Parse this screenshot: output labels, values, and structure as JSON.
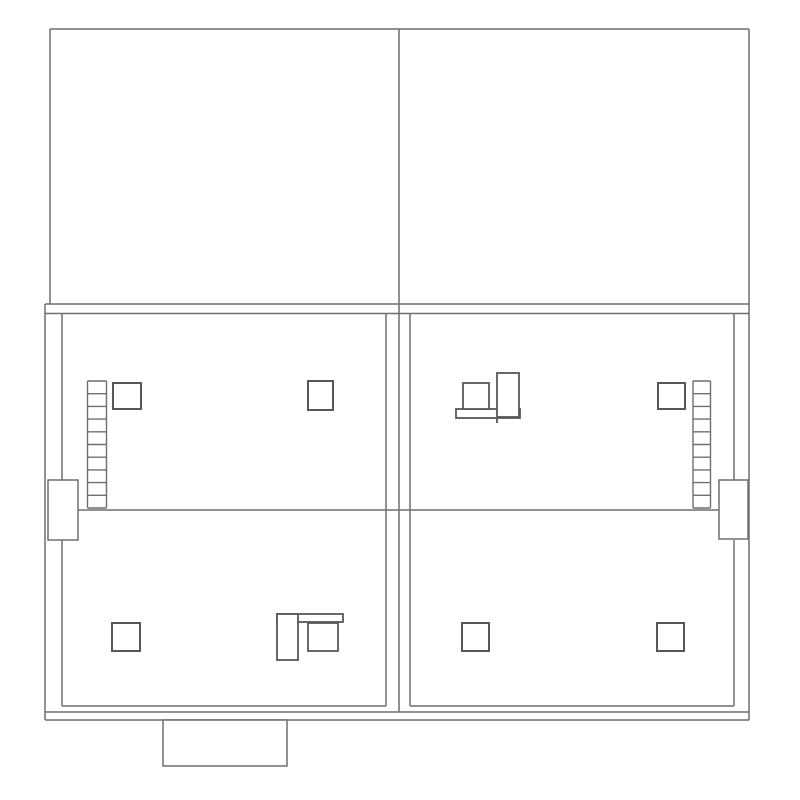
{
  "canvas": {
    "width": 800,
    "height": 800,
    "background": "#ffffff"
  },
  "style": {
    "wall_color": "#6f6f6f",
    "wall_width": 1.5,
    "detail_color": "#585858",
    "detail_width": 2,
    "ladder_color": "#6f6f6f",
    "ladder_width": 1.4,
    "fill_color": "#ffffff"
  },
  "walls": [
    {
      "name": "top-outline-top-edge",
      "x1": 50,
      "y1": 29,
      "x2": 749,
      "y2": 29
    },
    {
      "name": "top-left-outer-wall",
      "x1": 50,
      "y1": 29,
      "x2": 50,
      "y2": 304
    },
    {
      "name": "right-outer-wall",
      "x1": 749,
      "y1": 29,
      "x2": 749,
      "y2": 720
    },
    {
      "name": "center-dividing-wall",
      "x1": 399,
      "y1": 29,
      "x2": 399,
      "y2": 712
    },
    {
      "name": "slab-band-upper-line",
      "x1": 45,
      "y1": 304,
      "x2": 749,
      "y2": 304
    },
    {
      "name": "slab-band-lower-line",
      "x1": 45,
      "y1": 313.5,
      "x2": 749,
      "y2": 313.5
    },
    {
      "name": "left-outer-wall",
      "x1": 45,
      "y1": 304,
      "x2": 45,
      "y2": 720
    },
    {
      "name": "left-inner-wall-upper",
      "x1": 62,
      "y1": 313.5,
      "x2": 62,
      "y2": 480
    },
    {
      "name": "left-inner-wall-lower",
      "x1": 62,
      "y1": 540,
      "x2": 62,
      "y2": 706
    },
    {
      "name": "right-inner-wall-upper",
      "x1": 734,
      "y1": 313.5,
      "x2": 734,
      "y2": 480
    },
    {
      "name": "right-inner-wall-lower",
      "x1": 734,
      "y1": 540,
      "x2": 734,
      "y2": 706
    },
    {
      "name": "center-wall-left-line",
      "x1": 386,
      "y1": 313.5,
      "x2": 386,
      "y2": 706
    },
    {
      "name": "center-wall-right-line",
      "x1": 410,
      "y1": 313.5,
      "x2": 410,
      "y2": 706
    },
    {
      "name": "middle-room-divider",
      "x1": 78,
      "y1": 510,
      "x2": 720,
      "y2": 510
    },
    {
      "name": "inner-floor-line-left",
      "x1": 62,
      "y1": 706,
      "x2": 386,
      "y2": 706
    },
    {
      "name": "inner-floor-line-right",
      "x1": 410,
      "y1": 706,
      "x2": 734,
      "y2": 706
    },
    {
      "name": "bottom-wall-upper-line",
      "x1": 45,
      "y1": 712,
      "x2": 749,
      "y2": 712
    },
    {
      "name": "bottom-wall-lower-line",
      "x1": 45,
      "y1": 720,
      "x2": 749,
      "y2": 720
    }
  ],
  "boxes": [
    {
      "name": "left-wall-pier-box",
      "x": 48,
      "y": 480,
      "w": 30,
      "h": 60
    },
    {
      "name": "right-wall-pier-box",
      "x": 719,
      "y": 480,
      "w": 29,
      "h": 59
    },
    {
      "name": "bottom-extension-box",
      "x": 163,
      "y": 720,
      "w": 124,
      "h": 46
    }
  ],
  "columns": [
    {
      "name": "column-upper-left-a",
      "x": 113,
      "y": 383,
      "w": 28,
      "h": 26
    },
    {
      "name": "column-upper-left-b",
      "x": 308,
      "y": 381,
      "w": 25,
      "h": 29
    },
    {
      "name": "column-upper-right",
      "x": 658,
      "y": 383,
      "w": 27,
      "h": 26
    },
    {
      "name": "column-lower-left",
      "x": 112,
      "y": 623,
      "w": 28,
      "h": 28
    },
    {
      "name": "column-lower-right-a",
      "x": 462,
      "y": 623,
      "w": 27,
      "h": 28
    },
    {
      "name": "column-lower-right-b",
      "x": 657,
      "y": 623,
      "w": 27,
      "h": 28
    }
  ],
  "fixtures": [
    {
      "name": "fixture-upper-right-room",
      "rects": [
        {
          "name": "fixture-base-bar",
          "x": 456,
          "y": 409,
          "w": 64,
          "h": 9,
          "filled": false
        },
        {
          "name": "fixture-square-unit",
          "x": 463,
          "y": 383,
          "w": 26,
          "h": 26,
          "filled": true
        },
        {
          "name": "fixture-tall-unit",
          "x": 497,
          "y": 373,
          "w": 22,
          "h": 44,
          "filled": true
        }
      ],
      "ticks": [
        {
          "name": "fixture-tick-line",
          "x1": 497,
          "y1": 418,
          "x2": 497,
          "y2": 423
        }
      ]
    },
    {
      "name": "fixture-lower-left-room",
      "rects": [
        {
          "name": "fixture-base-bar",
          "x": 277,
          "y": 614,
          "w": 66,
          "h": 8,
          "filled": false
        },
        {
          "name": "fixture-tall-unit",
          "x": 277,
          "y": 614,
          "w": 21,
          "h": 46,
          "filled": true
        },
        {
          "name": "fixture-square-unit",
          "x": 308,
          "y": 623,
          "w": 30,
          "h": 28,
          "filled": true
        }
      ],
      "ticks": []
    }
  ],
  "ladders": [
    {
      "name": "ladder-left",
      "x1": 87.5,
      "y1": 381,
      "x2": 106.5,
      "y2": 508,
      "rungs": 11
    },
    {
      "name": "ladder-right",
      "x1": 693,
      "y1": 381,
      "x2": 710.5,
      "y2": 508,
      "rungs": 11
    }
  ]
}
